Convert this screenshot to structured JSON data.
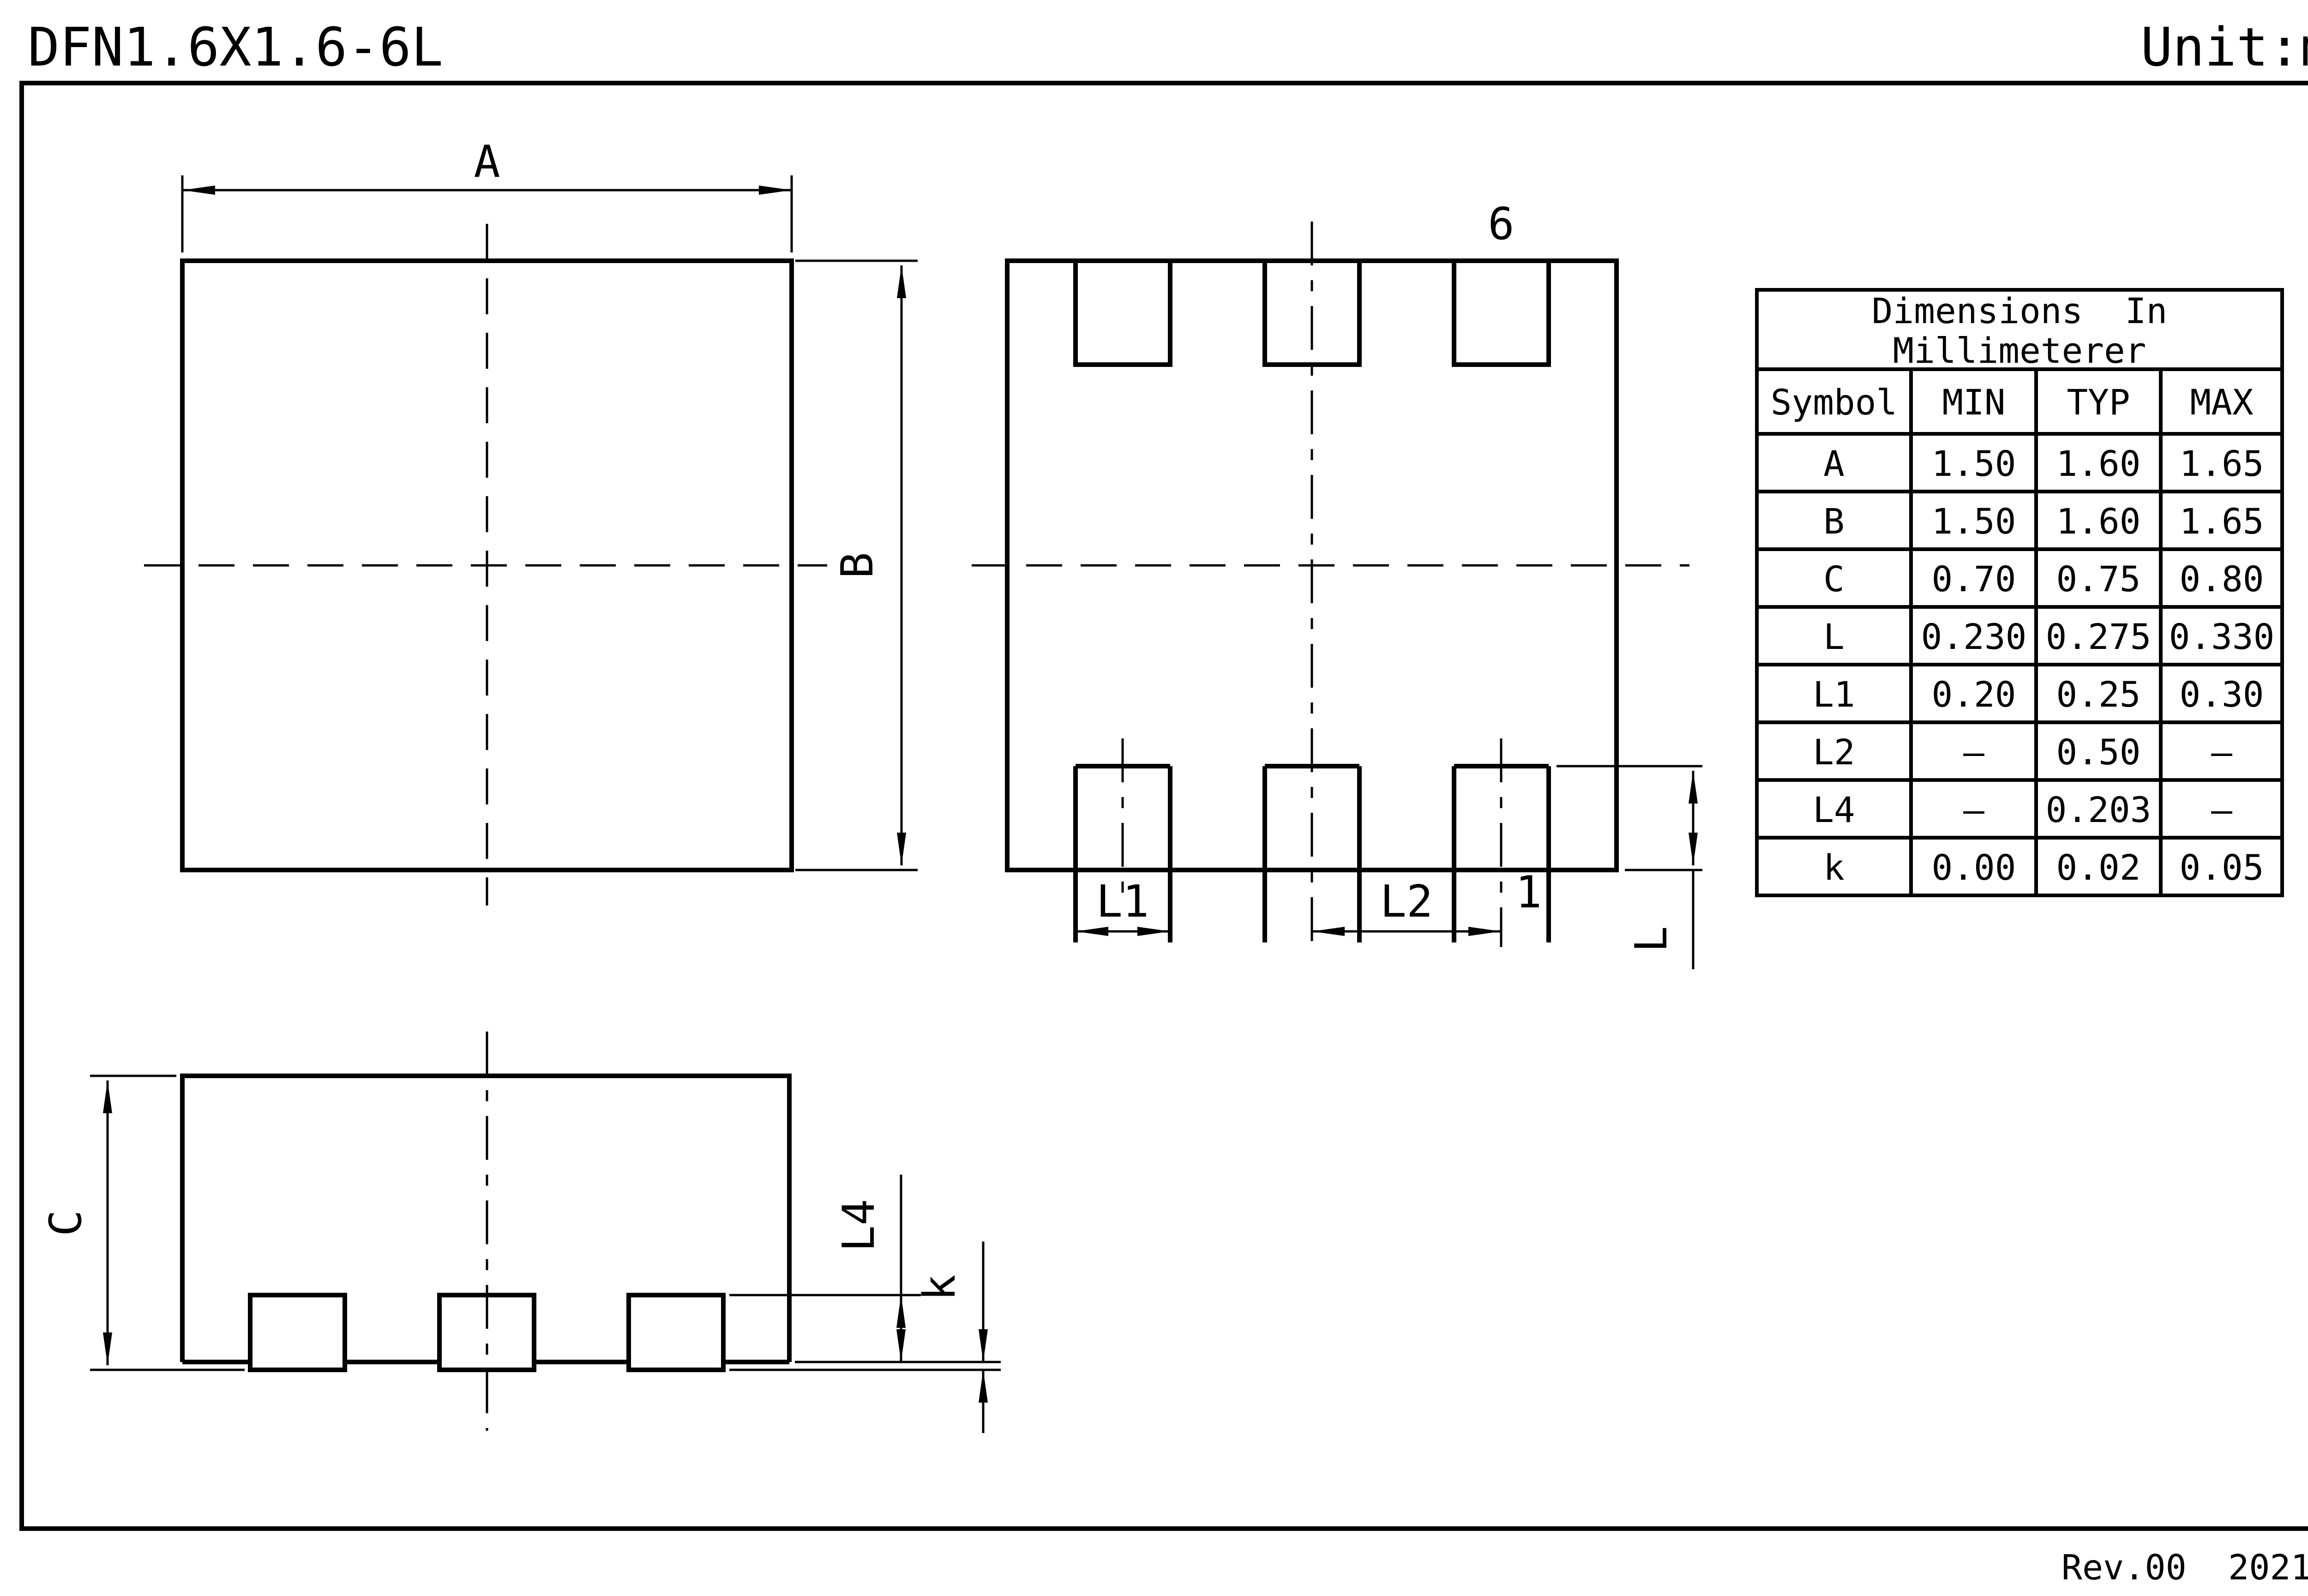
{
  "colors": {
    "ink": "#000000",
    "paper": "#ffffff"
  },
  "header": {
    "title": "DFN1.6X1.6-6L",
    "unit": "Unit:mm"
  },
  "footer": {
    "revision": "Rev.00  202107"
  },
  "drawing": {
    "top_view": {
      "dim_width": "A",
      "dim_height": "B"
    },
    "bottom_view": {
      "dim_pad_width": "L1",
      "dim_pad_pitch": "L2",
      "dim_pad_length": "L",
      "pin_first": "1",
      "pin_last": "6"
    },
    "side_view": {
      "dim_body_height": "C",
      "dim_lead_height": "L4",
      "dim_standoff": "k"
    }
  },
  "table": {
    "title_line1": "Dimensions  In",
    "title_line2": "Millimeterer",
    "columns": [
      "Symbol",
      "MIN",
      "TYP",
      "MAX"
    ],
    "rows": [
      {
        "symbol": "A",
        "min": "1.50",
        "typ": "1.60",
        "max": "1.65"
      },
      {
        "symbol": "B",
        "min": "1.50",
        "typ": "1.60",
        "max": "1.65"
      },
      {
        "symbol": "C",
        "min": "0.70",
        "typ": "0.75",
        "max": "0.80"
      },
      {
        "symbol": "L",
        "min": "0.230",
        "typ": "0.275",
        "max": "0.330"
      },
      {
        "symbol": "L1",
        "min": "0.20",
        "typ": "0.25",
        "max": "0.30"
      },
      {
        "symbol": "L2",
        "min": "–",
        "typ": "0.50",
        "max": "–"
      },
      {
        "symbol": "L4",
        "min": "–",
        "typ": "0.203",
        "max": "–"
      },
      {
        "symbol": "k",
        "min": "0.00",
        "typ": "0.02",
        "max": "0.05"
      }
    ]
  }
}
